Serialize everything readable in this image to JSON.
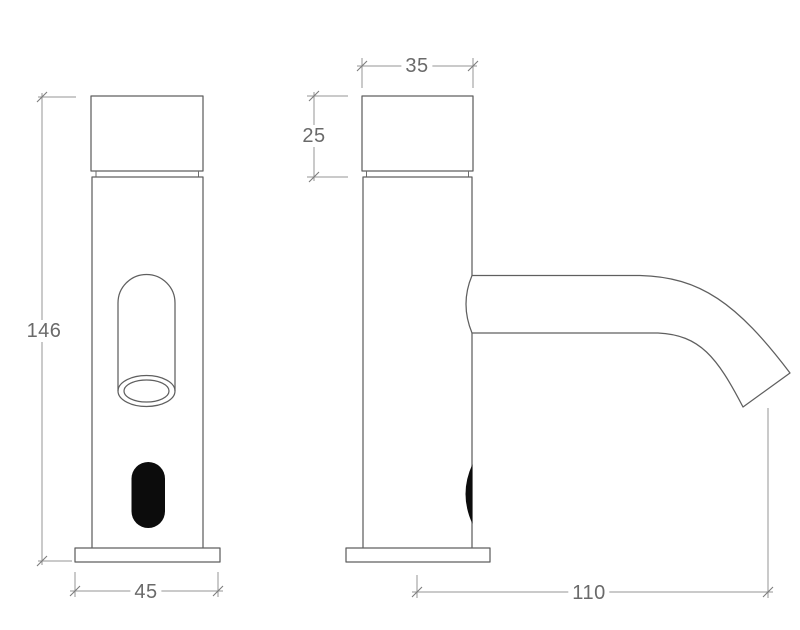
{
  "drawing": {
    "type": "technical-dimension-drawing",
    "subject": "sensor faucet, front and side orthographic views",
    "colors": {
      "background": "#ffffff",
      "outline": "#5f5f5f",
      "dimension_line": "#959595",
      "label_text": "#6a6a6a",
      "sensor_fill": "#0c0c0c"
    },
    "views": {
      "front": {
        "dimensions": {
          "height": "146",
          "base_width": "45"
        }
      },
      "side": {
        "dimensions": {
          "cap_width": "35",
          "cap_height": "25",
          "spout_reach": "110"
        }
      }
    }
  }
}
